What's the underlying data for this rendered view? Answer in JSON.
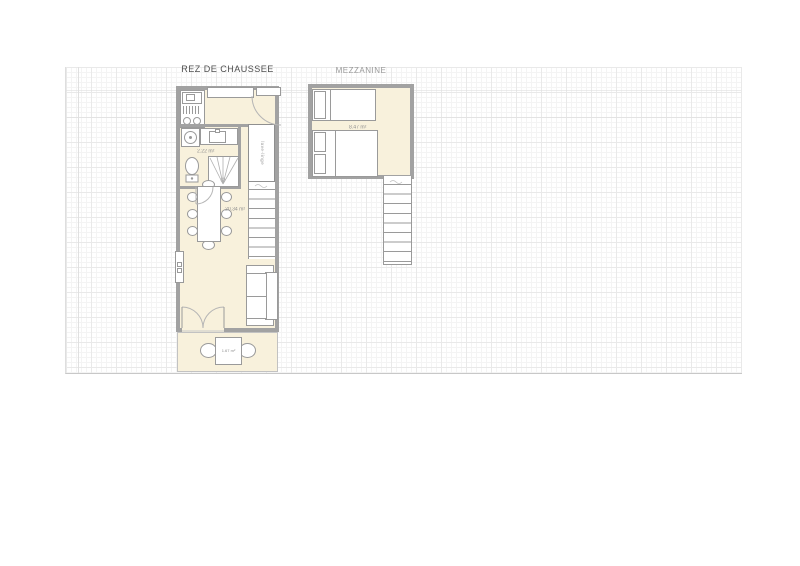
{
  "titles": {
    "ground_floor": "REZ DE CHAUSSEE",
    "mezzanine": "MEZZANINE"
  },
  "labels": {
    "living_area": "20.34 m²",
    "bathroom_area": "2.22 m²",
    "terrace_area": "1.67 m²",
    "mezzanine_area": "8.47 m²",
    "cabinet": "lave-linge"
  },
  "colors": {
    "wall": "#a2a2a2",
    "room_fill": "#f8f1dc",
    "furniture_stroke": "#9a9a9a",
    "label_text": "#8f8f8f",
    "title_text": "#4f4f4f",
    "subtitle_text": "#9a9a9a",
    "grid_minor": "#f4f4f4",
    "grid_major": "#e9e9e9"
  }
}
